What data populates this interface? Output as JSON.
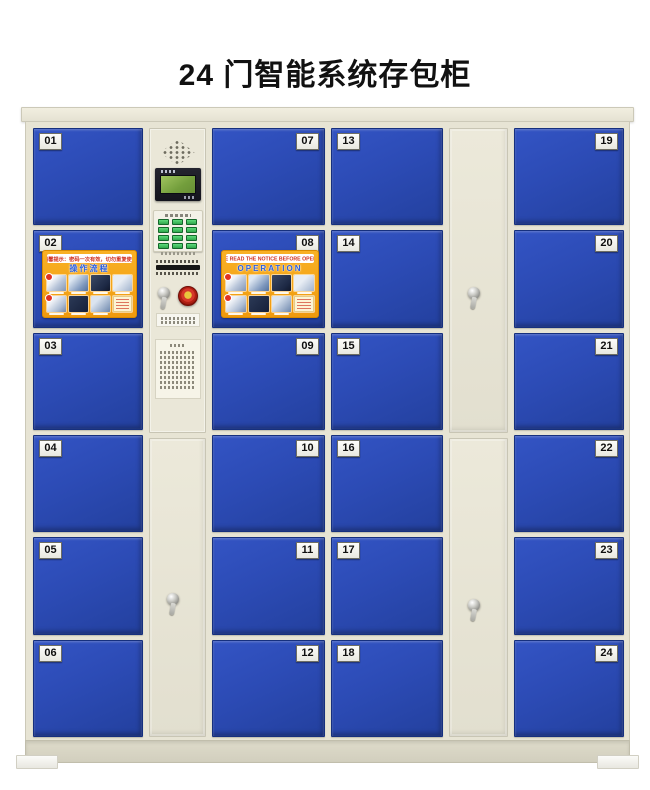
{
  "page": {
    "title": "24 门智能系统存包柜"
  },
  "colors": {
    "door_blue": "#2c4bb5",
    "frame_beige": "#e7e4d4",
    "base_beige": "#d2cfbe",
    "number_plate_bg": "#f2f2ec",
    "number_plate_text": "#0f0f0f",
    "sticker_orange": "#f6a41c",
    "sticker_title_blue": "#2b5ede",
    "keypad_green": "#3fba57",
    "emergency_red": "#c6271b",
    "emergency_center_yellow": "#e9c53c",
    "lcd_screen_green": "#739e3c",
    "lcd_bezel_dark": "#1a1a24"
  },
  "cabinet": {
    "columns": [
      {
        "type": "doors",
        "doors": [
          "01",
          "02",
          "03",
          "04",
          "05",
          "06"
        ],
        "label_side": "left",
        "sticker_door": "02",
        "sticker": 0
      },
      {
        "type": "control"
      },
      {
        "type": "doors",
        "doors": [
          "07",
          "08",
          "09",
          "10",
          "11",
          "12"
        ],
        "label_side": "right",
        "sticker_door": "08",
        "sticker": 1
      },
      {
        "type": "doors",
        "doors": [
          "13",
          "14",
          "15",
          "16",
          "17",
          "18"
        ],
        "label_side": "left"
      },
      {
        "type": "tall",
        "locks": 2
      },
      {
        "type": "doors",
        "doors": [
          "19",
          "20",
          "21",
          "22",
          "23",
          "24"
        ],
        "label_side": "right"
      }
    ],
    "control_panel": {
      "speaker_icon": "speaker-grill-icon",
      "display_icon": "lcd-display",
      "keypad_icon": "numeric-keypad",
      "keypad_key_count": 12,
      "barcode_icon": "barcode-label",
      "lock_icon": "key-lock",
      "emergency_button_icon": "emergency-stop-button",
      "service_label_icon": "service-hotline-label",
      "usage_notice_icon": "usage-notice-label"
    },
    "stickers": [
      {
        "header": "温馨提示：密码一次有效，切勿重复使用",
        "title": "操作流程",
        "tiles": [
          "pa",
          "pb",
          "pc",
          "pd",
          "pe",
          "pf",
          "pg",
          "notice"
        ],
        "badge_tiles": [
          0,
          4
        ]
      },
      {
        "header": "PLEASE READ THE NOTICE BEFORE OPERATION",
        "title": "OPERATION",
        "tiles": [
          "pa",
          "pb",
          "pc",
          "pd",
          "pe",
          "pf",
          "pg",
          "notice"
        ],
        "badge_tiles": [
          0,
          4
        ]
      }
    ]
  }
}
